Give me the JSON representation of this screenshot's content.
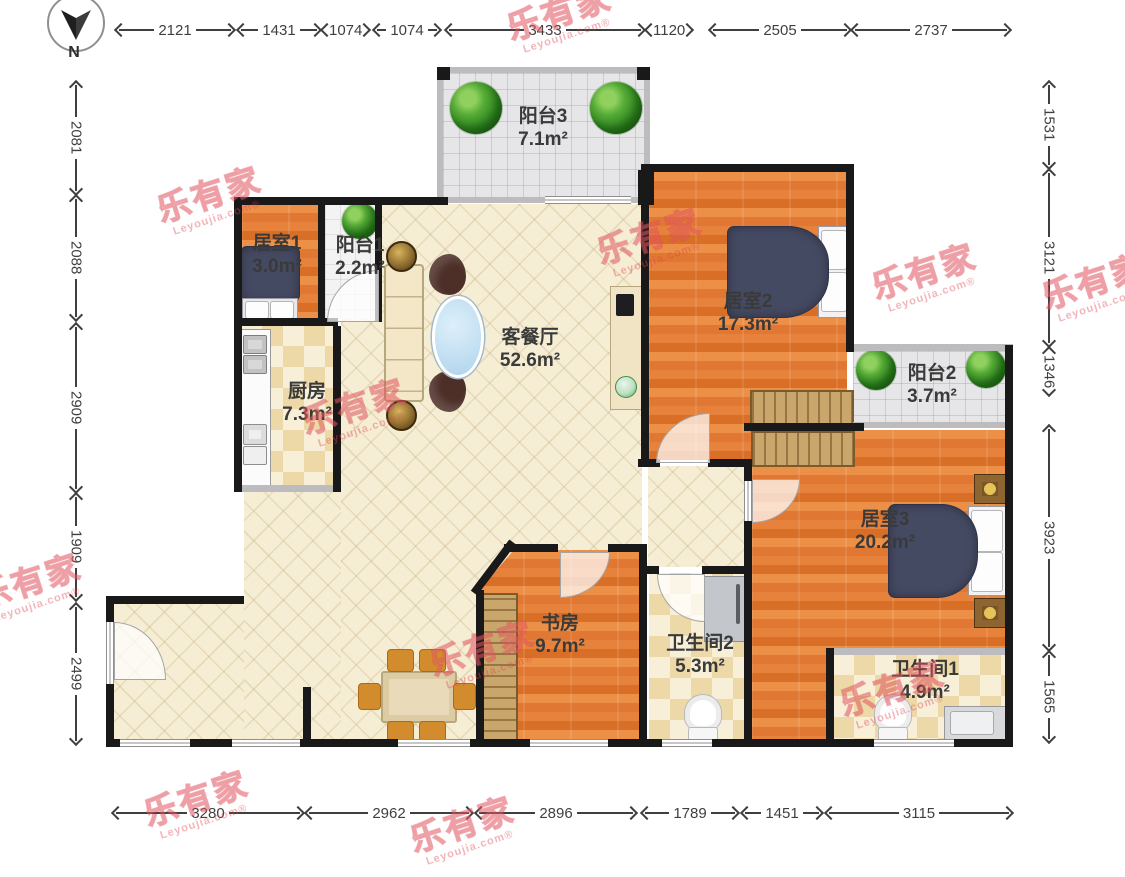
{
  "page": {
    "type": "apartment-floor-plan"
  },
  "compass": {
    "north_label": "N"
  },
  "dimensions": {
    "top": [
      "2121",
      "1431",
      "1074",
      "1074",
      "3433",
      "1120",
      "2505",
      "2737"
    ],
    "bottom": [
      "3280",
      "2962",
      "2896",
      "1789",
      "1451",
      "3115"
    ],
    "left": [
      "2081",
      "2088",
      "2909",
      "1909",
      "2499"
    ],
    "right": [
      "1531",
      "3121",
      "1346",
      "3923",
      "1565"
    ]
  },
  "rooms": [
    {
      "id": "balcony3",
      "name": "阳台3",
      "area": "7.1m²"
    },
    {
      "id": "bedroom1",
      "name": "居室1",
      "area": "3.0m²"
    },
    {
      "id": "balcony1",
      "name": "阳台1",
      "area": "2.2m²"
    },
    {
      "id": "living_dining",
      "name": "客餐厅",
      "area": "52.6m²"
    },
    {
      "id": "kitchen",
      "name": "厨房",
      "area": "7.3m²"
    },
    {
      "id": "bedroom2",
      "name": "居室2",
      "area": "17.3m²"
    },
    {
      "id": "balcony2",
      "name": "阳台2",
      "area": "3.7m²"
    },
    {
      "id": "bedroom3",
      "name": "居室3",
      "area": "20.2m²"
    },
    {
      "id": "study",
      "name": "书房",
      "area": "9.7m²"
    },
    {
      "id": "bathroom2",
      "name": "卫生间2",
      "area": "5.3m²"
    },
    {
      "id": "bathroom1",
      "name": "卫生间1",
      "area": "4.9m²"
    }
  ],
  "watermark": {
    "brand": "乐有家",
    "site": "Leyoujia.com",
    "reg": "®"
  },
  "colors": {
    "wall": "#191919",
    "wood_floor": "#e07b32",
    "living_floor": "#f6eed4",
    "tile_check": "#ecd9a7",
    "balcony_gray": "#e6e6e8",
    "watermark_red": "#de4652",
    "dimension_text": "#3f3f3f"
  }
}
